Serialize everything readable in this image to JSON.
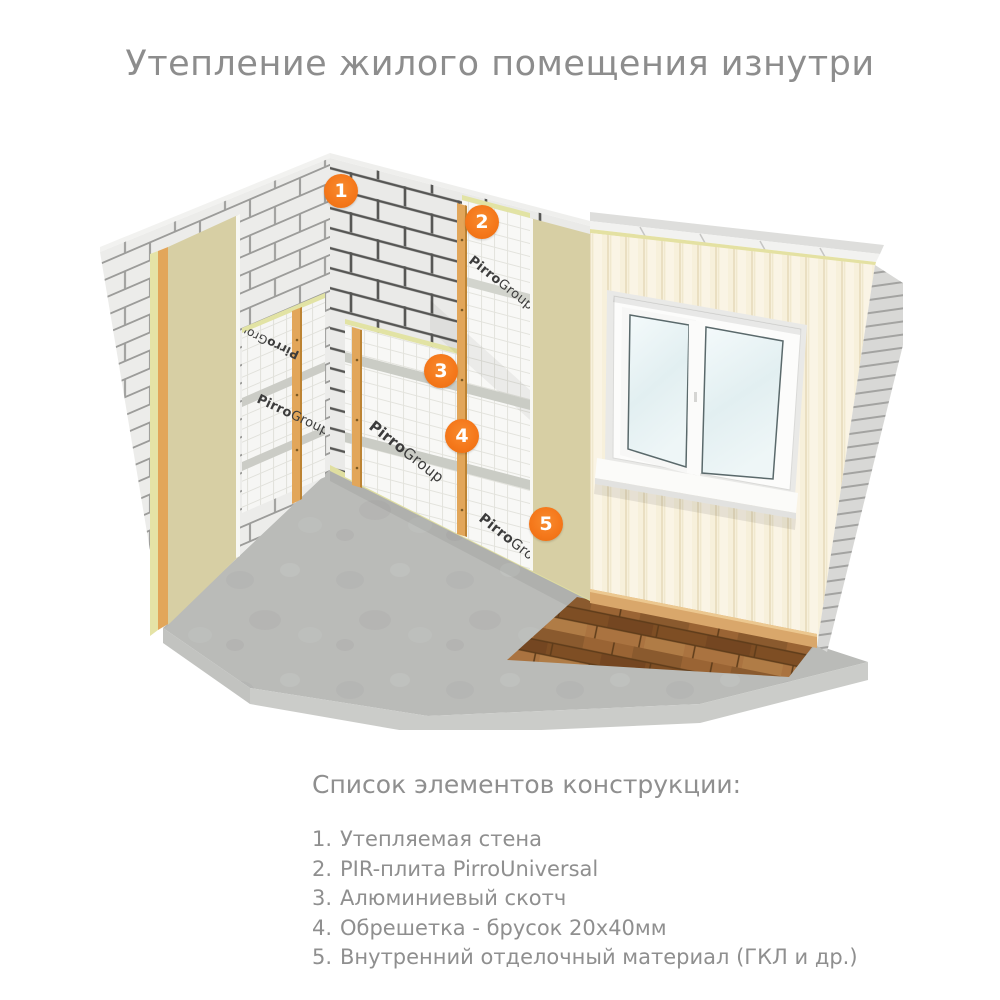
{
  "title": "Утепление жилого помещения изнутри",
  "illustration": {
    "brand": {
      "bold": "Pirro",
      "rest": "Group"
    },
    "markers": [
      {
        "label": "1"
      },
      {
        "label": "2"
      },
      {
        "label": "3"
      },
      {
        "label": "4"
      },
      {
        "label": "5"
      }
    ]
  },
  "legend": {
    "heading": "Список элементов конструкции:",
    "items": [
      {
        "num": "1.",
        "text": "Утепляемая стена"
      },
      {
        "num": "2.",
        "text": "PIR-плита PirroUniversal"
      },
      {
        "num": "3.",
        "text": "Алюминиевый скотч"
      },
      {
        "num": "4.",
        "text": "Обрешетка - брусок 20х40мм"
      },
      {
        "num": "5.",
        "text": "Внутренний отделочный материал (ГКЛ и др.)"
      }
    ]
  },
  "colors": {
    "accent_orange": "#F5781B",
    "text_gray": "#8D8D8D",
    "finish_panel_beige": "#D7CFA4",
    "batten_wood": "#E2A65A",
    "siding_cream": "#F7F0DB"
  }
}
